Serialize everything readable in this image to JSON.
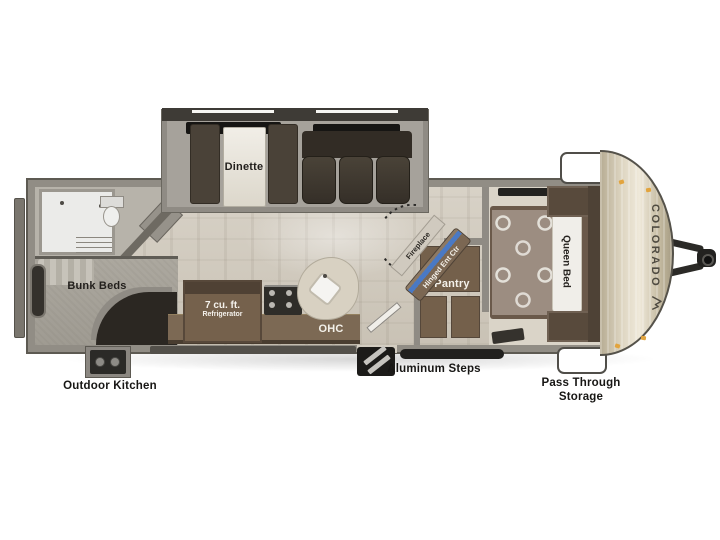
{
  "title": "Colorado travel trailer floor plan",
  "brand": {
    "name": "COLORADO",
    "logo_icon": "mountain-logo"
  },
  "colors": {
    "wall": "#918d85",
    "wall_dark": "#5d5a52",
    "floor": "#d3ccc0",
    "cabinet": "#74604b",
    "seat_brown": "#3b342c",
    "front_cap": "#ddd5c1",
    "fireplace_accent": "#4a79c4",
    "marker_light": "#e2a43e",
    "hatch_white": "#ffffff"
  },
  "labels": {
    "dinette": "Dinette",
    "bunk_beds": "Bunk Beds",
    "outdoor_kitchen": "Outdoor Kitchen",
    "refrigerator_size": "7 cu. ft.",
    "refrigerator": "Refrigerator",
    "ohc": "OHC",
    "fireplace": "Fireplace",
    "hinged_ent_ctr": "Hinged Ent Ctr",
    "pantry": "Pantry",
    "queen_bed": "Queen Bed",
    "aluminum_steps": "Aluminum Steps",
    "pass_through_line1": "Pass Through",
    "pass_through_line2": "Storage"
  }
}
